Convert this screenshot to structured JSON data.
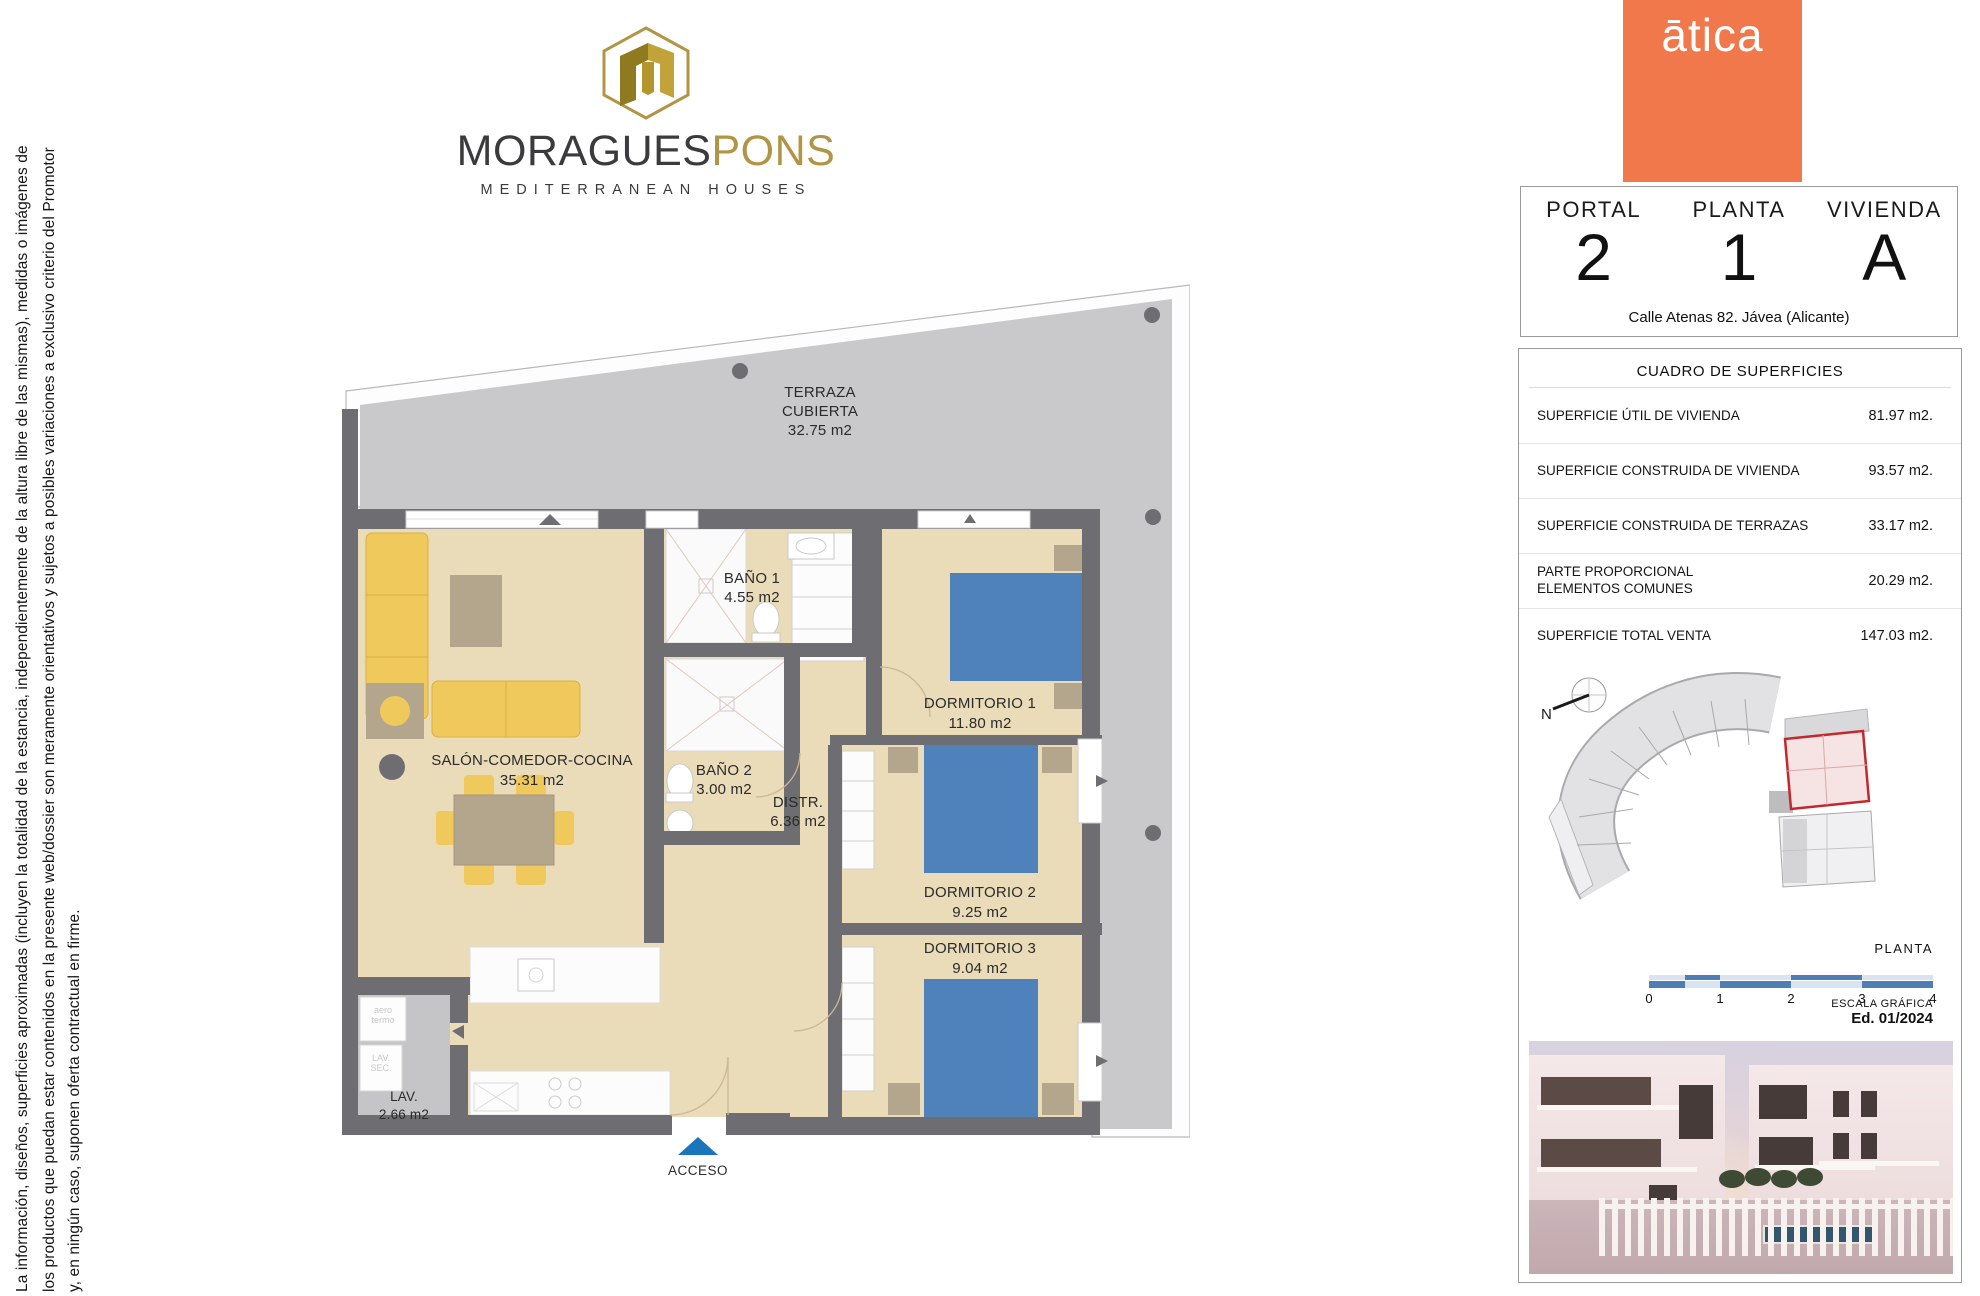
{
  "disclaimer": {
    "line1": "La información, diseños, superficies aproximadas (incluyen la totalidad de la estancia, independientemente de la altura libre de las mismas), medidas o imágenes de",
    "line2": "los productos que puedan estar contenidos en la presente web/dossier son meramente orientativos y sujetos a posibles variaciones a exclusivo criterio del Promotor",
    "line3": "y, en ningún caso, suponen oferta contractual en firme."
  },
  "brand": {
    "name_black": "MORAGUES",
    "name_gold": "PONS",
    "tagline": "MEDITERRANEAN HOUSES"
  },
  "developer_logo": {
    "text": "ātica"
  },
  "unit_card": {
    "fields": [
      {
        "label": "PORTAL",
        "value": "2"
      },
      {
        "label": "PLANTA",
        "value": "1"
      },
      {
        "label": "VIVIENDA",
        "value": "A"
      }
    ],
    "address": "Calle Atenas 82. Jávea (Alicante)"
  },
  "surface_table": {
    "title": "CUADRO DE SUPERFICIES",
    "rows": [
      {
        "label": "SUPERFICIE ÚTIL DE VIVIENDA",
        "value": "81.97 m2."
      },
      {
        "label": "SUPERFICIE CONSTRUIDA DE VIVIENDA",
        "value": "93.57 m2."
      },
      {
        "label": "SUPERFICIE CONSTRUIDA DE TERRAZAS",
        "value": "33.17 m2."
      },
      {
        "label": "PARTE PROPORCIONAL",
        "label2": "ELEMENTOS COMUNES",
        "value": "20.29 m2."
      },
      {
        "label": "SUPERFICIE TOTAL VENTA",
        "value": "147.03 m2."
      }
    ]
  },
  "site_plan": {
    "north_label": "N",
    "caption": "PLANTA"
  },
  "scale_bar": {
    "ticks": [
      "0",
      "1",
      "2",
      "3",
      "4"
    ],
    "caption": "ESCALA GRÁFICA",
    "edition": "Ed. 01/2024"
  },
  "floor_plan": {
    "rooms": [
      {
        "name": "TERRAZA",
        "name2": "CUBIERTA",
        "area": "32.75 m2"
      },
      {
        "name": "SALÓN-COMEDOR-COCINA",
        "area": "35.31 m2"
      },
      {
        "name": "BAÑO 1",
        "area": "4.55 m2"
      },
      {
        "name": "BAÑO 2",
        "area": "3.00 m2"
      },
      {
        "name": "DISTR.",
        "area": "6.36 m2"
      },
      {
        "name": "DORMITORIO 1",
        "area": "11.80 m2"
      },
      {
        "name": "DORMITORIO 2",
        "area": "9.25 m2"
      },
      {
        "name": "DORMITORIO 3",
        "area": "9.04 m2"
      },
      {
        "name": "LAV.",
        "area": "2.66 m2"
      }
    ],
    "entrance_label": "ACCESO",
    "appliances": {
      "water_heater_l1": "aero",
      "water_heater_l2": "termo",
      "laundry_l1": "LAV.",
      "laundry_l2": "SEC."
    }
  },
  "colors": {
    "accent_orange": "#f0784a",
    "brand_gold": "#b29544",
    "plan_wall": "#6e6e72",
    "plan_floor": "#eadcb9",
    "terrace_gray": "#c9c9cc",
    "bed_blue": "#4f81ba",
    "furniture_yellow": "#efc95c",
    "scalebar_blue": "#4f7eb5",
    "highlight_red": "#c3282e",
    "entrance_blue": "#1b75bb"
  }
}
